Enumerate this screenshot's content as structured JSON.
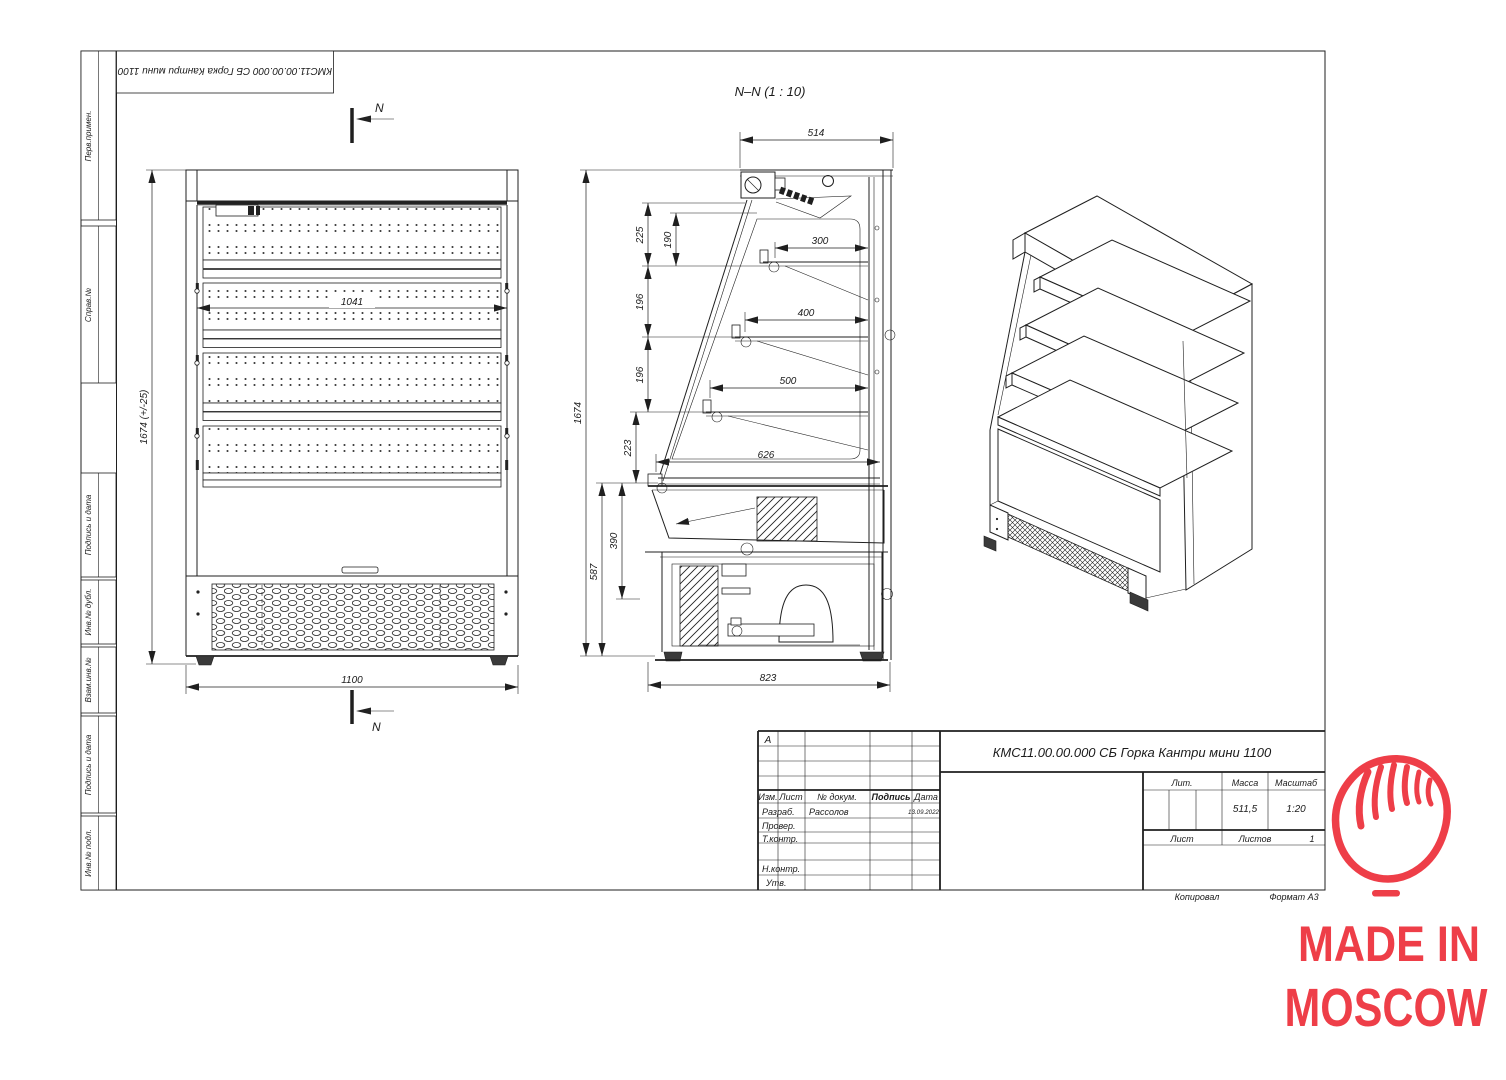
{
  "sheet": {
    "corner_stamp_text": "КМС11.00.00.000 СБ Горка Кантри мини 1100",
    "margin_labels": [
      "Перв.примен.",
      "Справ.№",
      "Подпись и дата",
      "Инв.№ дубл.",
      "Взам.инв.№",
      "Подпись и дата",
      "Инв.№ подл."
    ]
  },
  "front_view": {
    "dim_height": "1674 (+/-25)",
    "dim_inner_width": "1041",
    "dim_width": "1100",
    "cut_label": "N"
  },
  "section_view": {
    "title": "N–N (1 : 10)",
    "dims": {
      "depth_top": "514",
      "v225": "225",
      "v190": "190",
      "v196a": "196",
      "v196b": "196",
      "v223": "223",
      "height": "1674",
      "v390": "390",
      "v587": "587",
      "shelf1": "300",
      "shelf2": "400",
      "shelf3": "500",
      "deck": "626",
      "base_width": "823"
    }
  },
  "title_block": {
    "zone_letter": "А",
    "doc_number_title": "КМС11.00.00.000 СБ Горка Кантри мини 1100",
    "col_izm": "Изм.",
    "col_list": "Лист",
    "col_dokum": "№ докум.",
    "col_podpis": "Подпись",
    "col_data": "Дата",
    "rows": {
      "razrab": "Разраб.",
      "prover": "Провер.",
      "tkontr": "Т.контр.",
      "nkontr": "Н.контр.",
      "utv": "Утв."
    },
    "razrab_name": "Рассолов",
    "razrab_date": "13.09.2022",
    "lit_label": "Лит.",
    "massa_label": "Масса",
    "masshtab_label": "Масштаб",
    "massa_value": "511,5",
    "masshtab_value": "1:20",
    "list_label": "Лист",
    "listov_label": "Листов",
    "listov_value": "1",
    "kopiroval_label": "Копировал",
    "format_label": "Формат А3"
  },
  "logo": {
    "line1": "MADE IN",
    "line2": "MOSCOW",
    "color": "#EE3E48"
  }
}
